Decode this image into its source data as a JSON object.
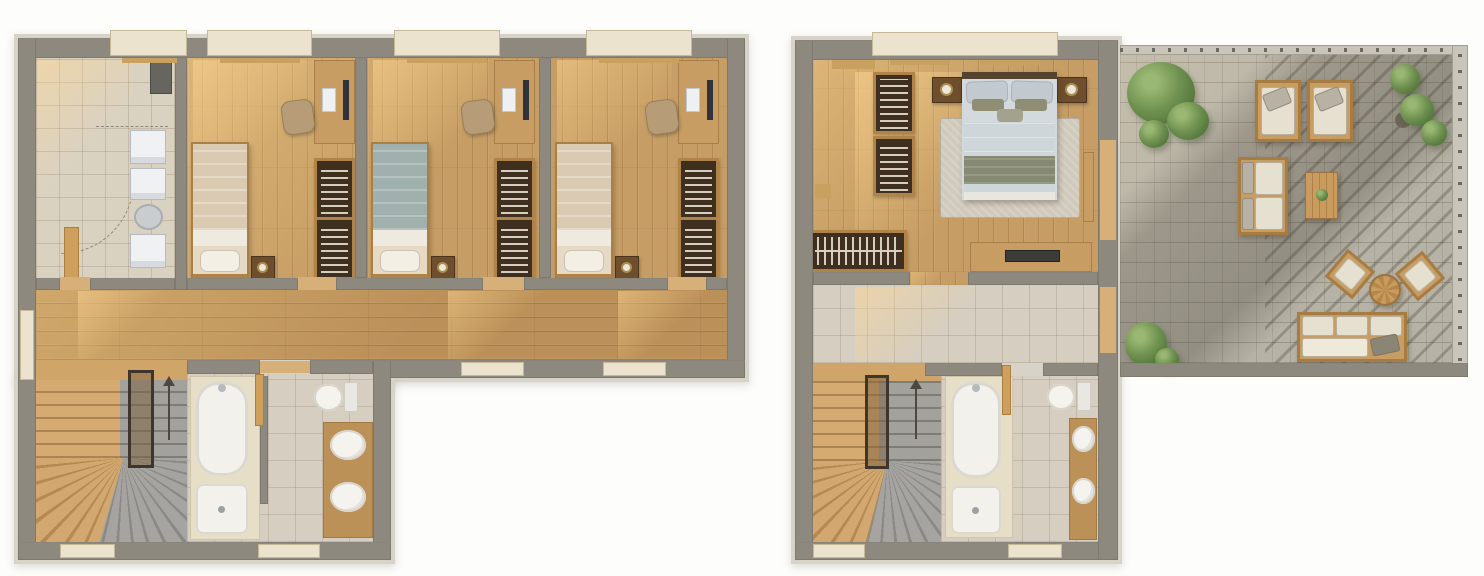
{
  "meta": {
    "description": "Top-down 3D rendered floor plans of a two-level home shown side by side: left plan with three bedrooms, entry, hallway, stairs and bathroom; right plan with master bedroom, landing, stairs, bathroom and a large paved roof terrace with outdoor furniture",
    "background": "#fdfdfb",
    "visible_text": ""
  },
  "palette": {
    "wall": "#8e897f",
    "wall_edging": "#d8d3c8",
    "wood_bedroom_floor": "#c69d64",
    "wood_hall_floor": "#bb9159",
    "tile_entry": "#dad2c1",
    "tile_bath": "#d6cec0",
    "terrace_pavers": "#b6b2a5",
    "stair_wood": "#d5ab72",
    "stair_stone": "#a3a19c",
    "sanitary_white": "#f2f1ec",
    "furniture_wood": "#c79d63",
    "wood_trim": "#b08449",
    "wardrobe_interior": "#3f2f1e",
    "duvet_beige": "#d9cab1",
    "duvet_sage": "#a0b1ad",
    "master_duvet": "#cfd6da",
    "master_blanket": "#878a73",
    "rug": "#d0cabd",
    "outdoor_cushion": "#e6e0d0",
    "plant_green": "#6f9150",
    "window_sill": "#ece3cf",
    "sun_light": "rgba(255,216,148,0.5)",
    "cast_shadow": "rgba(68,62,52,0.28)"
  },
  "plans": [
    {
      "id": "plan-left",
      "shape": "L-shaped",
      "rooms": [
        {
          "id": "entry",
          "floor": "tile",
          "items": [
            "utility-cabinet",
            "washer",
            "dryer",
            "laundry-basket",
            "appliance",
            "open-door",
            "door-swing-arc"
          ]
        },
        {
          "id": "bedroom-1",
          "floor": "wood",
          "items": [
            "single-bed-beige",
            "nightstand",
            "table-lamp",
            "desk",
            "desk-chair",
            "monitor",
            "wardrobe"
          ]
        },
        {
          "id": "bedroom-2",
          "floor": "wood",
          "items": [
            "single-bed-sage",
            "nightstand",
            "table-lamp",
            "desk",
            "desk-chair",
            "monitor",
            "wardrobe"
          ]
        },
        {
          "id": "bedroom-3",
          "floor": "wood",
          "items": [
            "single-bed-beige",
            "nightstand",
            "table-lamp",
            "desk",
            "desk-chair",
            "monitor",
            "wardrobe"
          ]
        },
        {
          "id": "hallway",
          "floor": "wood",
          "items": []
        },
        {
          "id": "staircase",
          "items": [
            "winder-stairs-wood",
            "winder-stairs-stone",
            "stairwell-railing",
            "direction-arrow"
          ]
        },
        {
          "id": "bathroom",
          "floor": "tile",
          "items": [
            "bathtub",
            "shower-tray",
            "bath-door",
            "toilet",
            "vanity-counter",
            "washbasin",
            "washbasin"
          ]
        }
      ],
      "windows": 9
    },
    {
      "id": "plan-right",
      "shape": "rectangular wing with roof terrace",
      "rooms": [
        {
          "id": "master-bedroom",
          "floor": "wood",
          "items": [
            "double-bed",
            "pillows",
            "nightstand-left",
            "nightstand-right",
            "table-lamp",
            "table-lamp",
            "rug",
            "shelving-unit",
            "shelving-unit",
            "walk-in-closet",
            "desk",
            "laptop",
            "wall-shelf"
          ]
        },
        {
          "id": "landing",
          "floor": "tile",
          "items": []
        },
        {
          "id": "staircase",
          "items": [
            "winder-stairs-wood",
            "winder-stairs-stone",
            "stairwell-railing",
            "direction-arrow"
          ]
        },
        {
          "id": "bathroom",
          "floor": "tile",
          "items": [
            "bathtub",
            "shower-tray",
            "bath-door",
            "toilet",
            "vanity-counter",
            "washbasin",
            "washbasin"
          ]
        },
        {
          "id": "terrace",
          "floor": "stone-pavers",
          "items": [
            "tree",
            "lounge-chair",
            "lounge-chair",
            "potted-plant",
            "potted-plant",
            "potted-plant",
            "two-seat-sofa",
            "coffee-table",
            "armchair",
            "armchair",
            "round-side-table",
            "three-seat-sofa",
            "shrub",
            "pergola-shadow",
            "perimeter-railing",
            "terrace-door",
            "terrace-door"
          ]
        }
      ],
      "windows": 4
    }
  ]
}
